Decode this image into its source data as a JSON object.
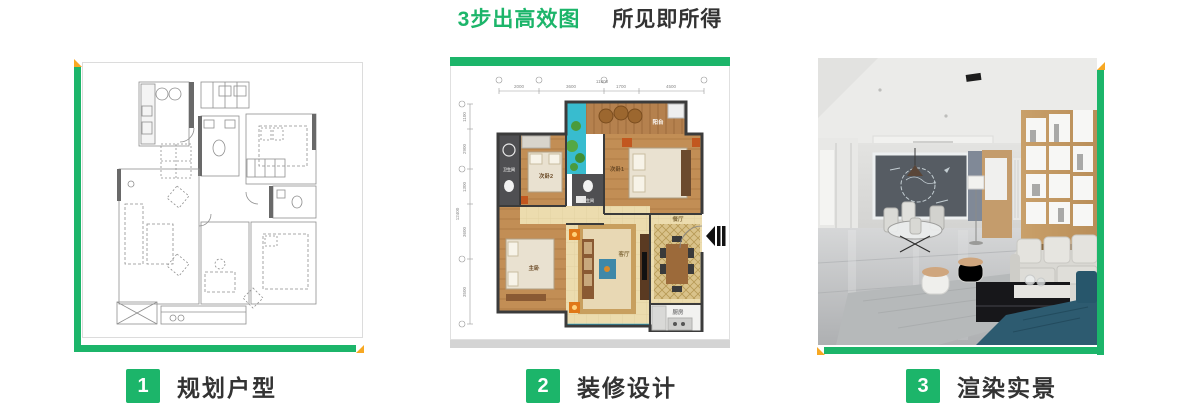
{
  "header": {
    "title_highlight": "3步出高效图",
    "title_rest": "所见即所得"
  },
  "steps": [
    {
      "number": "1",
      "label": "规划户型"
    },
    {
      "number": "2",
      "label": "装修设计"
    },
    {
      "number": "3",
      "label": "渲染实景"
    }
  ],
  "floorplan_colored": {
    "dim_total_top": "11800",
    "dims_top": [
      "2000",
      "3600",
      "1700",
      "4500"
    ],
    "dim_total_left": "12400",
    "dims_left": [
      "1100",
      "2900",
      "1300",
      "3600",
      "3500"
    ],
    "rooms": {
      "balcony": "阳台",
      "bedroom1": "次卧1",
      "bedroom2": "次卧2",
      "master": "主卧",
      "living": "客厅",
      "dining": "餐厅",
      "kitchen": "厨房",
      "bath1": "卫生间",
      "bath2": "卫生间"
    }
  },
  "colors": {
    "accent_green": "#1cb56a",
    "accent_yellow": "#f7a823",
    "title_text": "#333333",
    "card_border": "#dcdcdc",
    "base_strip": "#d4d4d4"
  }
}
